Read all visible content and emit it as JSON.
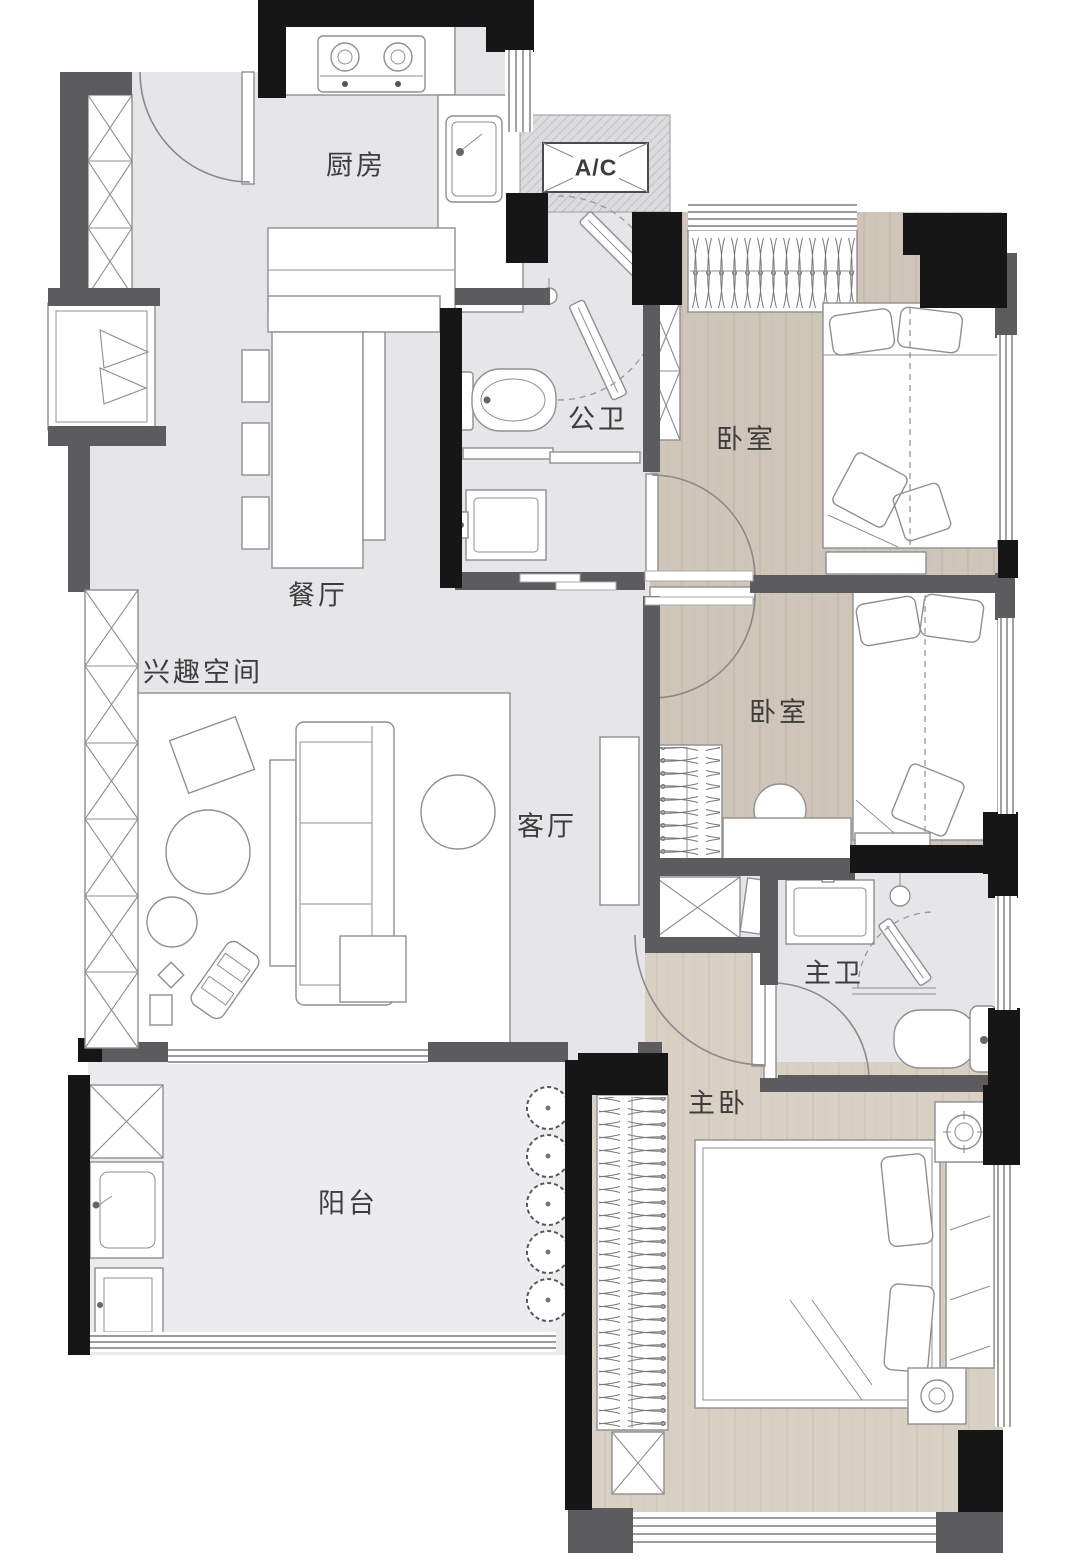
{
  "meta": {
    "kind": "apartment-floor-plan",
    "width_px": 1080,
    "height_px": 1565
  },
  "colors": {
    "wall": "#161616",
    "wall2": "#5c5c5e",
    "marble": "#e6e6e8",
    "marble_light": "#ececee",
    "wood": "#cfc6b9",
    "wood_light": "#d8d0c3",
    "furniture_outline": "#8f8f8f",
    "window_line": "#7b7b7b",
    "label": "#3d3d3d"
  },
  "rooms": [
    {
      "id": "kitchen",
      "label": "厨房"
    },
    {
      "id": "ac-unit",
      "label": "A/C"
    },
    {
      "id": "guest-bathroom",
      "label": "公卫"
    },
    {
      "id": "bedroom-1",
      "label": "卧室"
    },
    {
      "id": "bedroom-2",
      "label": "卧室"
    },
    {
      "id": "dining-room",
      "label": "餐厅"
    },
    {
      "id": "hobby-space",
      "label": "兴趣空间"
    },
    {
      "id": "living-room",
      "label": "客厅"
    },
    {
      "id": "master-bathroom",
      "label": "主卫"
    },
    {
      "id": "master-bedroom",
      "label": "主卧"
    },
    {
      "id": "balcony",
      "label": "阳台"
    }
  ]
}
